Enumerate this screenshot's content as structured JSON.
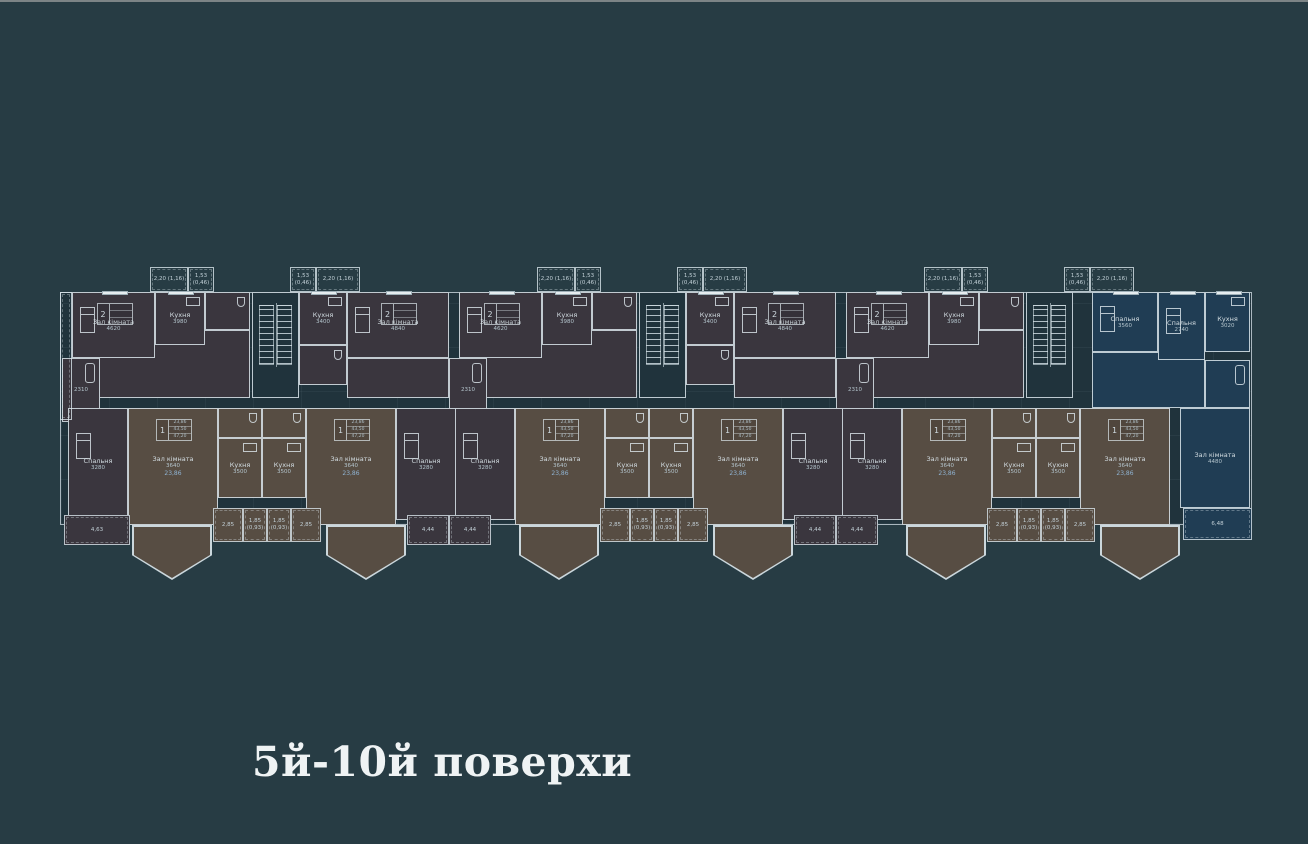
{
  "page": {
    "background": "#273c44",
    "top_border_color": "#7c8486"
  },
  "caption": {
    "text": "5й-10й поверхи"
  },
  "plan": {
    "colors": {
      "wall": "#dae5eb",
      "common": "#20333c",
      "flat2": "#3a363e",
      "flat1": "#574d43",
      "flat3": "#203d54",
      "label": "#d3dde2",
      "area_accent": "#8fb3d2"
    },
    "base": {
      "x": 60,
      "y": 292,
      "w": 1192,
      "h": 233
    },
    "section_x": [
      62,
      449,
      836
    ],
    "flat_tables": {
      "1": {
        "idx": "1",
        "rows": [
          "23,86",
          "43,50",
          "47,20"
        ]
      },
      "2": {
        "idx": "2",
        "rows": [
          "",
          "",
          ""
        ]
      }
    },
    "template": [
      {
        "t": "balcony",
        "n": "balcony-top",
        "x": 88,
        "y": 267,
        "w": 38,
        "h": 25,
        "lab": "2,20 (1,16)",
        "secs": [
          0,
          1,
          2
        ]
      },
      {
        "t": "balcony",
        "n": "balcony-top",
        "x": 126,
        "y": 267,
        "w": 26,
        "h": 25,
        "lab": "1,53 (0,46)",
        "secs": [
          0,
          1,
          2
        ]
      },
      {
        "t": "balcony",
        "n": "balcony-top",
        "x": 228,
        "y": 267,
        "w": 26,
        "h": 25,
        "lab": "1,53 (0,46)",
        "secs": [
          0,
          1,
          2
        ]
      },
      {
        "t": "balcony",
        "n": "balcony-top",
        "x": 254,
        "y": 267,
        "w": 44,
        "h": 25,
        "lab": "2,20 (1,16)",
        "secs": [
          0,
          1,
          2
        ]
      },
      {
        "t": "room",
        "n": "room-hall",
        "x": 10,
        "y": 330,
        "w": 178,
        "h": 68,
        "f": "flat2",
        "secs": [
          0,
          1,
          2
        ]
      },
      {
        "t": "room",
        "n": "room-living",
        "x": 10,
        "y": 292,
        "w": 83,
        "h": 66,
        "f": "flat2",
        "lab": "Зал кімната",
        "dim": "4620",
        "win": "top",
        "bed": true,
        "table": "2",
        "secs": [
          0,
          1,
          2
        ]
      },
      {
        "t": "room",
        "n": "room-kitchen",
        "x": 93,
        "y": 292,
        "w": 50,
        "h": 53,
        "f": "flat2",
        "lab": "Кухня",
        "dim": "3980",
        "win": "top",
        "fix": "stove",
        "secs": [
          0,
          1,
          2
        ]
      },
      {
        "t": "room",
        "n": "room-wc",
        "x": 143,
        "y": 292,
        "w": 45,
        "h": 38,
        "f": "flat2",
        "fix": "wc",
        "secs": [
          0,
          1,
          2
        ]
      },
      {
        "t": "room",
        "n": "room-bath",
        "x": 0,
        "y": 358,
        "w": 38,
        "h": 64,
        "f": "flat2",
        "dim": "2310",
        "fix": "tub",
        "secs": [
          0,
          1,
          2
        ]
      },
      {
        "t": "stair",
        "n": "stair-core",
        "x": 190,
        "y": 292,
        "w": 47,
        "h": 106,
        "secs": [
          0,
          1,
          2
        ]
      },
      {
        "t": "room",
        "n": "room-hall",
        "x": 285,
        "y": 358,
        "w": 102,
        "h": 40,
        "f": "flat2",
        "secs": [
          0,
          1
        ]
      },
      {
        "t": "room",
        "n": "room-kitchen",
        "x": 237,
        "y": 292,
        "w": 48,
        "h": 53,
        "f": "flat2",
        "lab": "Кухня",
        "dim": "3400",
        "win": "top",
        "fix": "stove",
        "secs": [
          0,
          1
        ]
      },
      {
        "t": "room",
        "n": "room-living",
        "x": 285,
        "y": 292,
        "w": 102,
        "h": 66,
        "f": "flat2",
        "lab": "Зал кімната",
        "dim": "4840",
        "win": "top",
        "bed": true,
        "table": "2",
        "secs": [
          0,
          1
        ]
      },
      {
        "t": "room",
        "n": "room-wc",
        "x": 237,
        "y": 345,
        "w": 48,
        "h": 40,
        "f": "flat2",
        "fix": "wc",
        "secs": [
          0,
          1
        ]
      },
      {
        "t": "room",
        "n": "room-bedroom",
        "x": 6,
        "y": 408,
        "w": 60,
        "h": 112,
        "f": "flat2",
        "lab": "Спальня",
        "dim": "3280",
        "bed": true,
        "secs": [
          0,
          1,
          2
        ]
      },
      {
        "t": "room",
        "n": "room-living",
        "x": 66,
        "y": 408,
        "w": 90,
        "h": 117,
        "f": "flat1",
        "lab": "Зал кімната",
        "dim": "3640",
        "area": "23,86",
        "table": "1",
        "secs": [
          0,
          1,
          2
        ]
      },
      {
        "t": "room",
        "n": "room-wc",
        "x": 156,
        "y": 408,
        "w": 44,
        "h": 30,
        "f": "flat1",
        "fix": "wc",
        "secs": [
          0,
          1,
          2
        ]
      },
      {
        "t": "room",
        "n": "room-kitchen",
        "x": 156,
        "y": 438,
        "w": 44,
        "h": 60,
        "f": "flat1",
        "lab": "Кухня",
        "dim": "3500",
        "fix": "stove",
        "secs": [
          0,
          1,
          2
        ]
      },
      {
        "t": "room",
        "n": "room-wc",
        "x": 200,
        "y": 408,
        "w": 44,
        "h": 30,
        "f": "flat1",
        "fix": "wc",
        "secs": [
          0,
          1,
          2
        ]
      },
      {
        "t": "room",
        "n": "room-kitchen",
        "x": 200,
        "y": 438,
        "w": 44,
        "h": 60,
        "f": "flat1",
        "lab": "Кухня",
        "dim": "3500",
        "fix": "stove",
        "secs": [
          0,
          1,
          2
        ]
      },
      {
        "t": "room",
        "n": "room-living",
        "x": 244,
        "y": 408,
        "w": 90,
        "h": 117,
        "f": "flat1",
        "lab": "Зал кімната",
        "dim": "3640",
        "area": "23,86",
        "table": "1",
        "secs": [
          0,
          1,
          2
        ]
      },
      {
        "t": "room",
        "n": "room-bedroom",
        "x": 334,
        "y": 408,
        "w": 60,
        "h": 112,
        "f": "flat2",
        "lab": "Спальня",
        "dim": "3280",
        "bed": true,
        "secs": [
          0,
          1
        ]
      },
      {
        "t": "bay",
        "n": "bay-window",
        "x": 70,
        "y": 525,
        "w": 80,
        "h": 55,
        "f": "flat1",
        "secs": [
          0,
          1,
          2
        ]
      },
      {
        "t": "bay",
        "n": "bay-window",
        "x": 264,
        "y": 525,
        "w": 80,
        "h": 55,
        "f": "flat1",
        "secs": [
          0,
          1,
          2
        ]
      },
      {
        "t": "balcony",
        "n": "balcony-bottom",
        "x": 151,
        "y": 508,
        "w": 30,
        "h": 34,
        "lab": "2,85",
        "f": "flat1",
        "secs": [
          0,
          1,
          2
        ]
      },
      {
        "t": "balcony",
        "n": "balcony-bottom",
        "x": 181,
        "y": 508,
        "w": 24,
        "h": 34,
        "lab": "1,85 (0,93)",
        "f": "flat1",
        "secs": [
          0,
          1,
          2
        ]
      },
      {
        "t": "balcony",
        "n": "balcony-bottom",
        "x": 205,
        "y": 508,
        "w": 24,
        "h": 34,
        "lab": "1,85 (0,93)",
        "f": "flat1",
        "secs": [
          0,
          1,
          2
        ]
      },
      {
        "t": "balcony",
        "n": "balcony-bottom",
        "x": 229,
        "y": 508,
        "w": 30,
        "h": 34,
        "lab": "2,85",
        "f": "flat1",
        "secs": [
          0,
          1,
          2
        ]
      }
    ],
    "extras": [
      {
        "t": "balcony",
        "n": "balcony-left-loggia",
        "x": 60,
        "y": 292,
        "w": 12,
        "h": 128
      },
      {
        "t": "balcony",
        "n": "balcony-bottom",
        "x": 64,
        "y": 515,
        "w": 66,
        "h": 30,
        "lab": "4,63",
        "f": "flat2"
      },
      {
        "t": "balcony",
        "n": "balcony-bottom",
        "x": 407,
        "y": 515,
        "w": 42,
        "h": 30,
        "lab": "4,44",
        "f": "flat2"
      },
      {
        "t": "balcony",
        "n": "balcony-bottom",
        "x": 449,
        "y": 515,
        "w": 42,
        "h": 30,
        "lab": "4,44",
        "f": "flat2"
      },
      {
        "t": "balcony",
        "n": "balcony-bottom",
        "x": 794,
        "y": 515,
        "w": 42,
        "h": 30,
        "lab": "4,44",
        "f": "flat2"
      },
      {
        "t": "balcony",
        "n": "balcony-bottom",
        "x": 836,
        "y": 515,
        "w": 42,
        "h": 30,
        "lab": "4,44",
        "f": "flat2"
      },
      {
        "t": "room",
        "n": "room-hall",
        "x": 1092,
        "y": 352,
        "w": 113,
        "h": 56,
        "f": "flat3"
      },
      {
        "t": "room",
        "n": "room-bedroom",
        "x": 1092,
        "y": 292,
        "w": 66,
        "h": 60,
        "f": "flat3",
        "lab": "Спальня",
        "dim": "3560",
        "win": "top",
        "bed": true
      },
      {
        "t": "room",
        "n": "room-bedroom",
        "x": 1158,
        "y": 292,
        "w": 47,
        "h": 68,
        "f": "flat3",
        "lab": "Спальня",
        "dim": "2740",
        "win": "top",
        "bed": true
      },
      {
        "t": "room",
        "n": "room-kitchen",
        "x": 1205,
        "y": 292,
        "w": 45,
        "h": 60,
        "f": "flat3",
        "lab": "Кухня",
        "dim": "3020",
        "win": "top",
        "fix": "stove"
      },
      {
        "t": "room",
        "n": "room-bath",
        "x": 1205,
        "y": 360,
        "w": 45,
        "h": 48,
        "f": "flat3",
        "fix": "tub"
      },
      {
        "t": "room",
        "n": "room-living",
        "x": 1180,
        "y": 408,
        "w": 70,
        "h": 100,
        "f": "flat3",
        "lab": "Зал кімната",
        "dim": "4480"
      },
      {
        "t": "balcony",
        "n": "balcony-bottom",
        "x": 1183,
        "y": 508,
        "w": 69,
        "h": 32,
        "lab": "6,48",
        "f": "flat3"
      }
    ]
  }
}
